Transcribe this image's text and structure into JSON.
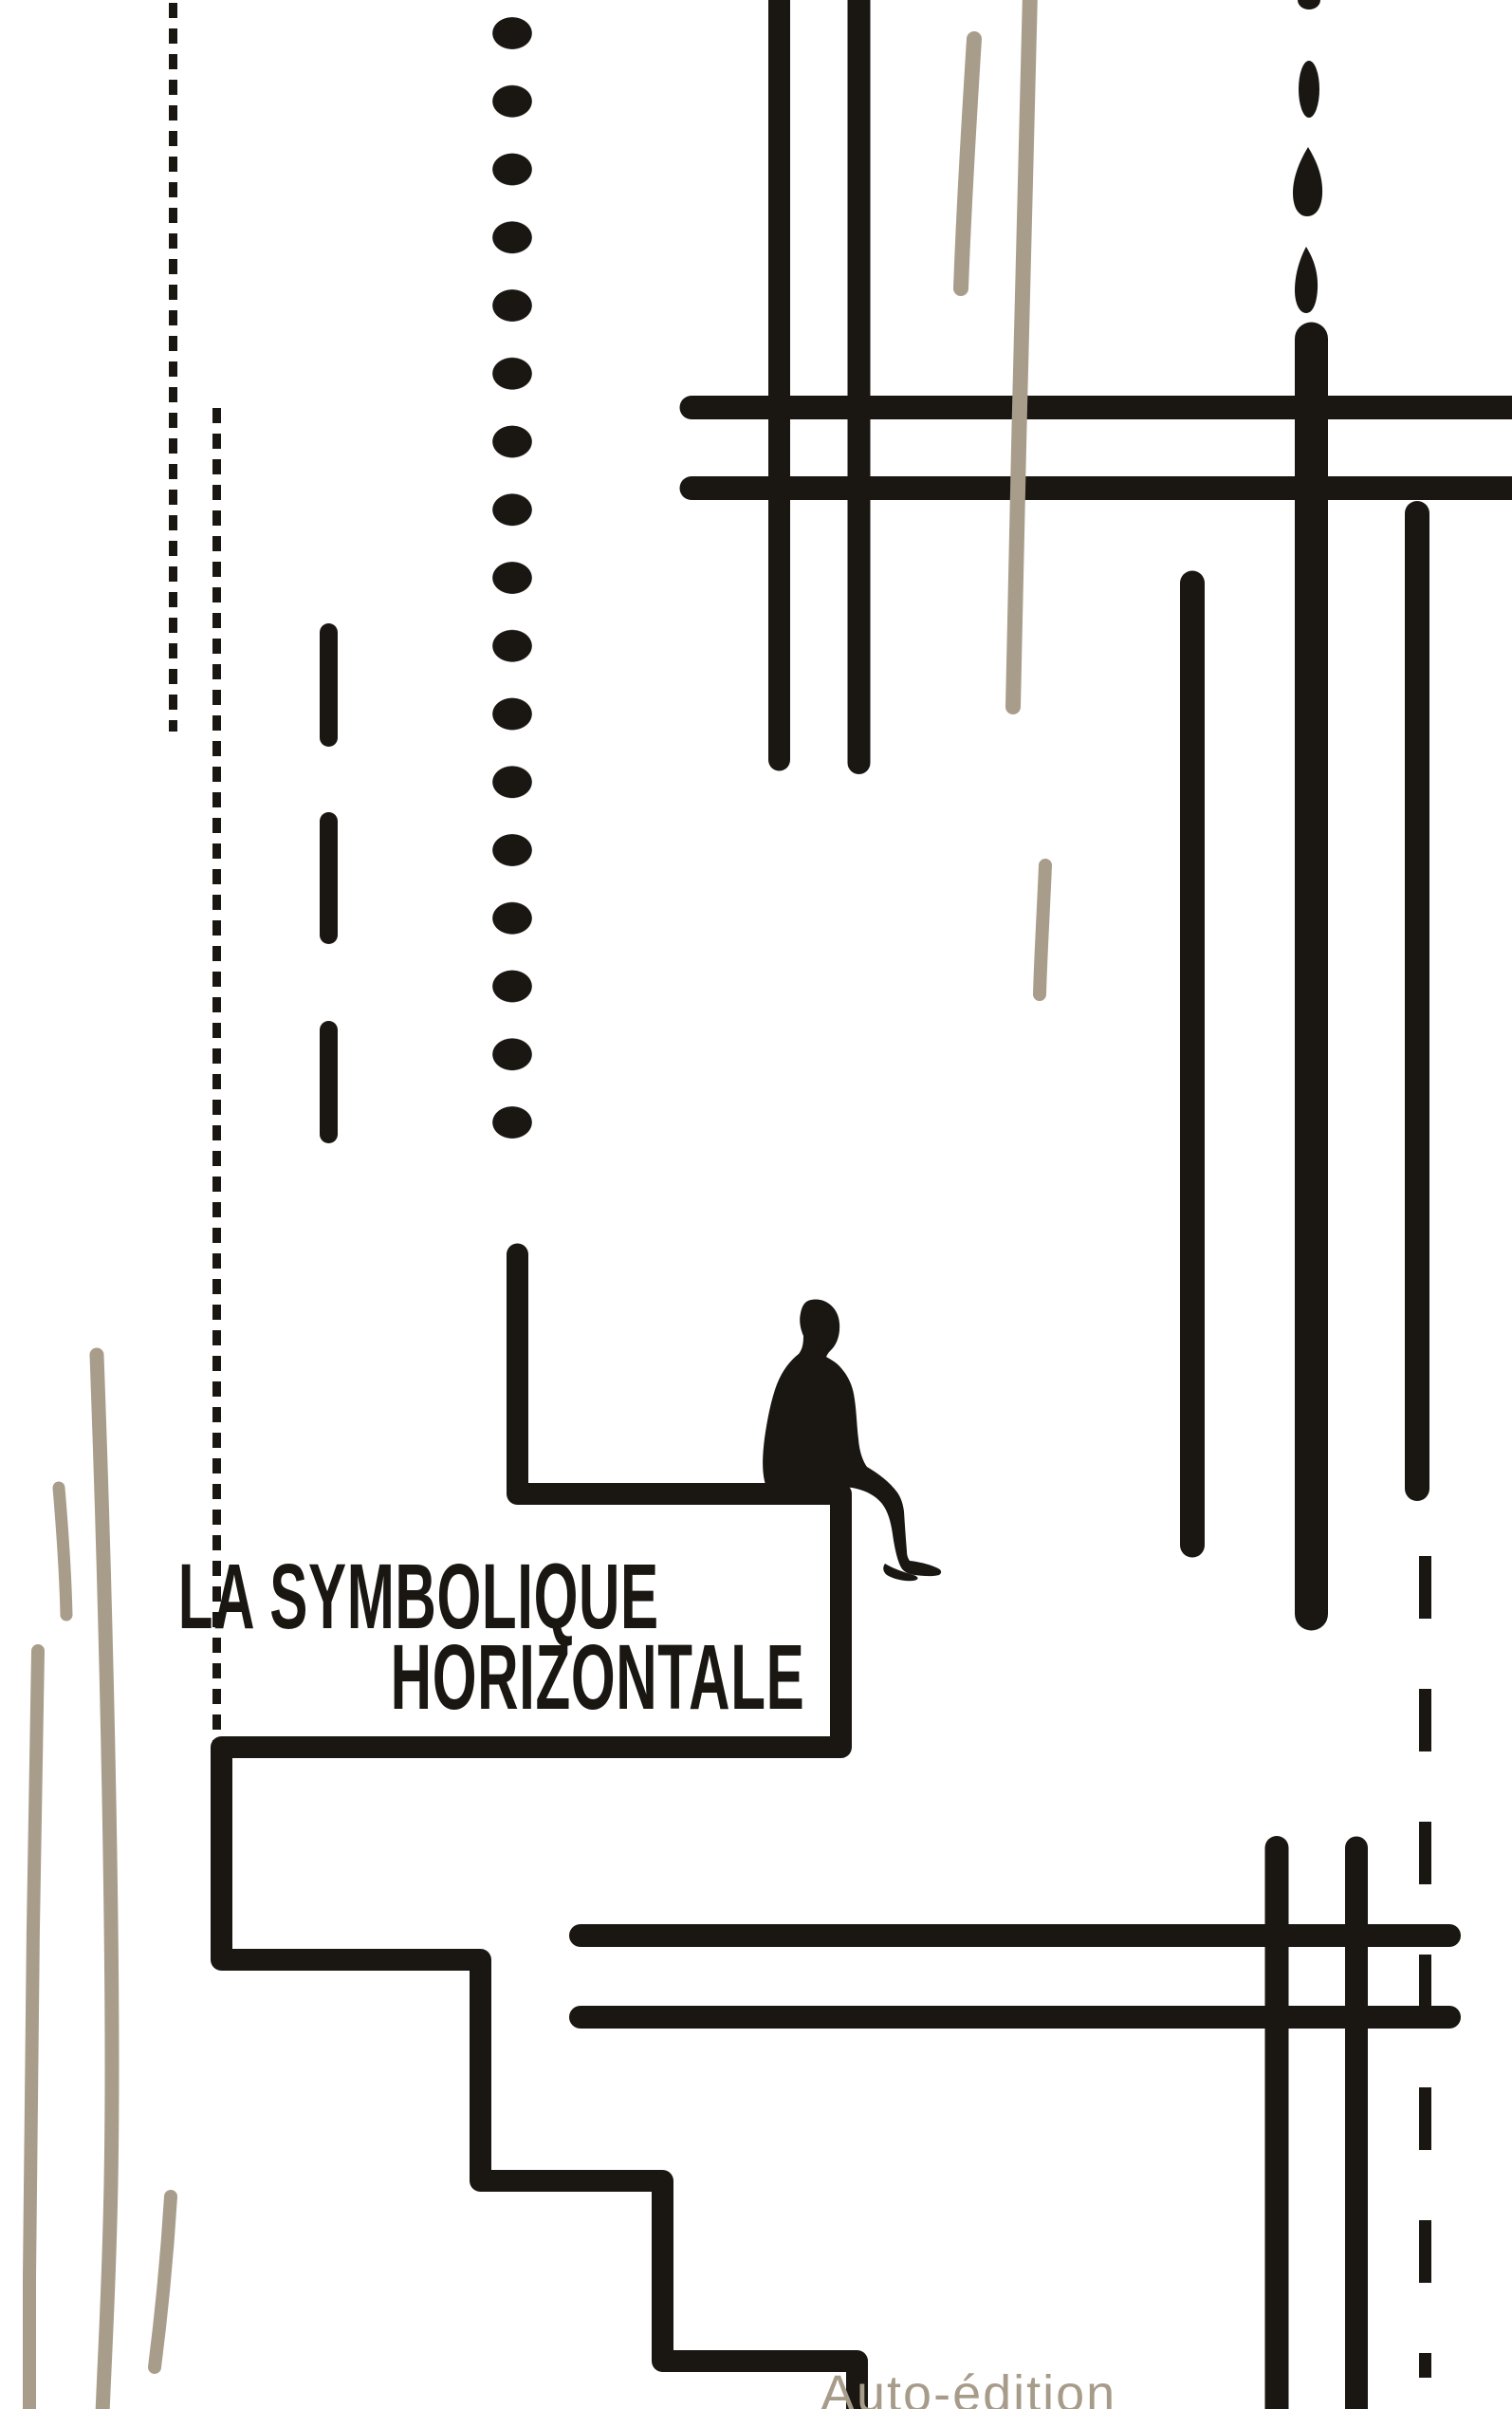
{
  "cover": {
    "title_line1": "LA SYMBOLIQUE",
    "title_line2": "HORIZONTALE",
    "publisher": "Auto-édition",
    "colors": {
      "ink": "#1a1713",
      "beige": "#a89d8b",
      "publisher_text": "#a79c8a",
      "background": "#ffffff"
    }
  }
}
